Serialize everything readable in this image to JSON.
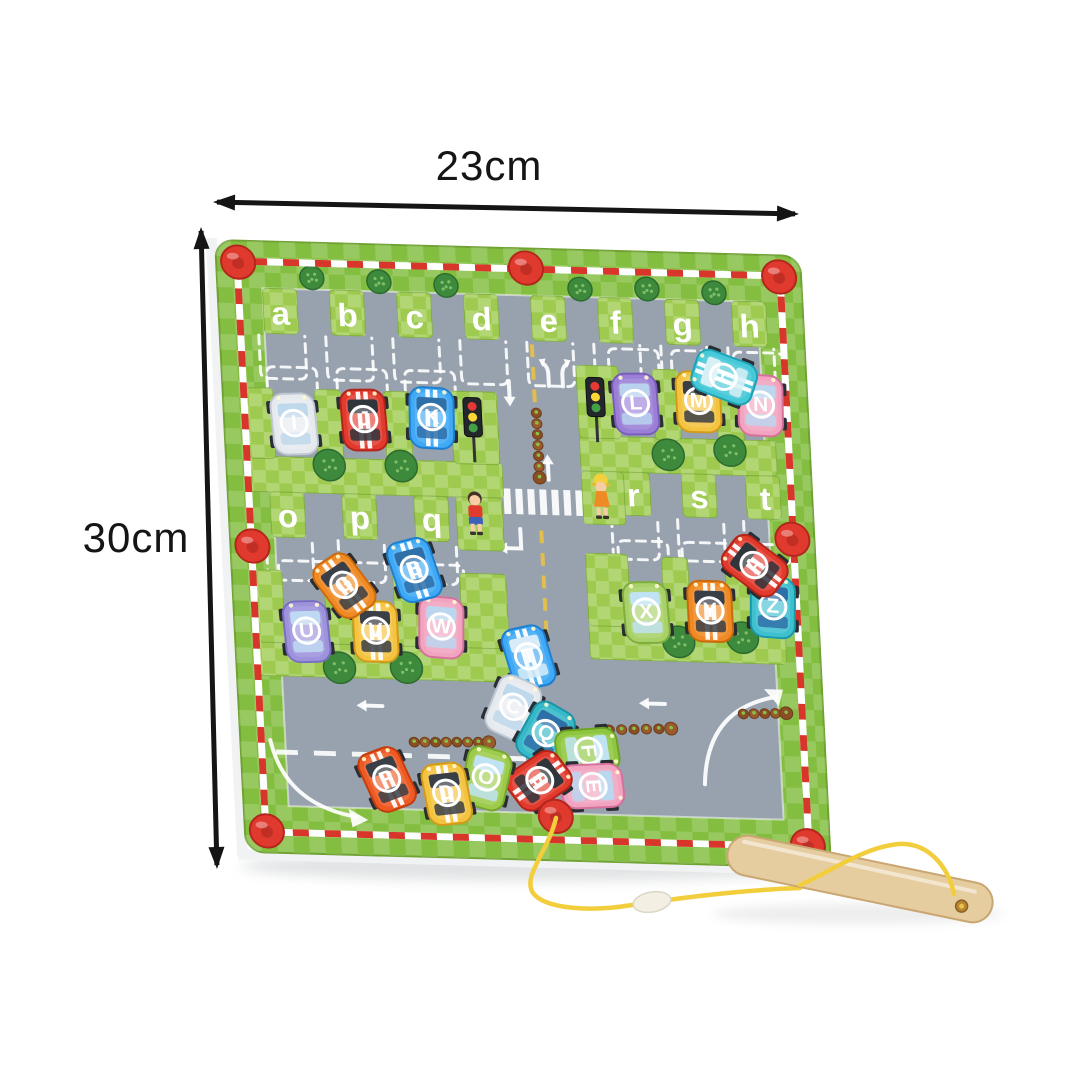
{
  "annotations": {
    "width_label": "23cm",
    "height_label": "30cm"
  },
  "colors": {
    "background": "#ffffff",
    "border_green": "#84BE41",
    "border_check": "rgba(255,255,255,0.17)",
    "maze_green": "#9ECB4F",
    "maze_check": "rgba(255,255,255,0.22)",
    "play_gray": "#98A2AE",
    "track_red": "#D8362B",
    "track_white": "#FFFFFF",
    "knob_red": "#E03A2F",
    "knob_dark": "#B3261C",
    "slot_dash": "#FFFFFF",
    "letter_white": "#FFFFFF",
    "road_yellow": "#E2BE4E",
    "tree_green": "#3E8A3C",
    "tree_dark": "#2C6B2F",
    "tree_dot": "#7FBF6A",
    "caterpillar_body": "#9A5A2B",
    "caterpillar_alt": "#8A4E22",
    "caterpillar_line": "#6B3E1D",
    "caterpillar_dot": "#86C34D",
    "wand_wood": "#E6CDA0",
    "wand_edge": "#C9A672",
    "string_yellow": "#F2CE3C",
    "bead": "#F3EFE2",
    "bead_edge": "#DCD6C4",
    "arrow_black": "#151515",
    "rim_white": "#F0F2F3",
    "shadow": "rgba(120,128,134,0.22)"
  },
  "dim_arrows": [
    [
      213,
      202,
      799,
      214
    ],
    [
      201,
      227,
      217,
      869
    ]
  ],
  "board": {
    "matrix": "matrix(1 0.0274 0.0496 0.979 215 240)",
    "width": 585,
    "height": 625,
    "border": 45,
    "top_letters": [
      "a",
      "b",
      "c",
      "d",
      "e",
      "f",
      "g",
      "h"
    ],
    "top_letter_xs": [
      62,
      129,
      196,
      263,
      330,
      397,
      464,
      531
    ],
    "top_letter_y": 73,
    "mid_left": {
      "letters": [
        "o",
        "p",
        "q"
      ],
      "xs": [
        59,
        131,
        203
      ],
      "y": 280
    },
    "mid_right": {
      "letters": [
        "r",
        "s",
        "t"
      ],
      "xs": [
        406,
        472,
        538
      ],
      "y": 249
    },
    "bars": [
      [
        20,
        220,
        256,
        36
      ],
      [
        355,
        190,
        196,
        36
      ],
      [
        18,
        408,
        266,
        36
      ],
      [
        355,
        382,
        196,
        36
      ]
    ],
    "tabs": [
      [
        45,
        48,
        34,
        46
      ],
      [
        112,
        48,
        34,
        46
      ],
      [
        179,
        48,
        34,
        46
      ],
      [
        246,
        48,
        34,
        46
      ],
      [
        313,
        48,
        34,
        46
      ],
      [
        380,
        48,
        34,
        46
      ],
      [
        447,
        48,
        34,
        46
      ],
      [
        514,
        48,
        34,
        46
      ],
      [
        24,
        150,
        26,
        72
      ],
      [
        92,
        150,
        26,
        72
      ],
      [
        161,
        150,
        26,
        72
      ],
      [
        228,
        148,
        46,
        74
      ],
      [
        42,
        256,
        34,
        46
      ],
      [
        114,
        256,
        34,
        46
      ],
      [
        186,
        256,
        34,
        46
      ],
      [
        228,
        256,
        46,
        54
      ],
      [
        355,
        118,
        42,
        74
      ],
      [
        431,
        120,
        26,
        72
      ],
      [
        494,
        118,
        26,
        74
      ],
      [
        389,
        226,
        34,
        44
      ],
      [
        455,
        226,
        34,
        44
      ],
      [
        519,
        226,
        34,
        44
      ],
      [
        355,
        226,
        42,
        54
      ],
      [
        24,
        336,
        26,
        74
      ],
      [
        92,
        336,
        26,
        74
      ],
      [
        161,
        336,
        26,
        74
      ],
      [
        228,
        334,
        46,
        76
      ],
      [
        355,
        310,
        42,
        74
      ],
      [
        431,
        312,
        26,
        72
      ],
      [
        494,
        310,
        26,
        74
      ]
    ],
    "slots_open_top": [
      [
        62,
        96,
        140,
        46
      ],
      [
        129,
        96,
        140,
        46
      ],
      [
        196,
        96,
        140,
        46
      ],
      [
        263,
        96,
        140,
        46
      ],
      [
        330,
        96,
        140,
        46
      ],
      [
        397,
        96,
        140,
        46
      ],
      [
        464,
        96,
        140,
        46
      ],
      [
        531,
        96,
        140,
        46
      ],
      [
        59,
        304,
        346,
        46
      ],
      [
        131,
        304,
        346,
        46
      ],
      [
        203,
        304,
        346,
        46
      ],
      [
        406,
        273,
        315,
        46
      ],
      [
        472,
        273,
        315,
        46
      ],
      [
        538,
        273,
        315,
        46
      ]
    ],
    "slots_open_bottom": [
      [
        70,
        128,
        212,
        50
      ],
      [
        140,
        128,
        212,
        50
      ],
      [
        208,
        128,
        212,
        50
      ],
      [
        413,
        100,
        184,
        50
      ],
      [
        476,
        100,
        184,
        50
      ],
      [
        538,
        100,
        184,
        50
      ],
      [
        72,
        326,
        404,
        50
      ],
      [
        141,
        326,
        404,
        50
      ],
      [
        207,
        326,
        404,
        50
      ],
      [
        413,
        296,
        376,
        50
      ],
      [
        477,
        296,
        376,
        50
      ],
      [
        540,
        296,
        376,
        50
      ]
    ],
    "trees": [
      [
        95,
        36,
        12
      ],
      [
        162,
        38,
        12
      ],
      [
        229,
        40,
        12
      ],
      [
        363,
        40,
        12
      ],
      [
        430,
        38,
        12
      ],
      [
        497,
        40,
        12
      ],
      [
        103,
        227,
        16
      ],
      [
        175,
        226,
        16
      ],
      [
        443,
        207,
        16
      ],
      [
        505,
        201,
        16
      ],
      [
        103,
        434,
        16
      ],
      [
        170,
        432,
        16
      ],
      [
        444,
        398,
        16
      ],
      [
        508,
        392,
        16
      ]
    ],
    "knobs": [
      [
        22,
        22
      ],
      [
        310,
        20
      ],
      [
        563,
        22
      ],
      [
        22,
        312
      ],
      [
        563,
        290
      ],
      [
        22,
        603
      ],
      [
        563,
        603
      ],
      [
        312,
        580
      ]
    ],
    "traffic_lights": [
      [
        249,
        178
      ],
      [
        373,
        154
      ]
    ],
    "kids": [
      {
        "x": 247,
        "y": 272,
        "variant": "boy"
      },
      {
        "x": 374,
        "y": 252,
        "variant": "girl"
      }
    ],
    "caterpillars": [
      [
        313,
        168,
        313,
        234
      ],
      [
        174,
        508,
        249,
        506
      ],
      [
        370,
        490,
        432,
        487
      ],
      [
        505,
        470,
        548,
        468
      ]
    ],
    "road": {
      "center_dash_x": 312,
      "center_dash_segments": [
        [
          98,
          168
        ],
        [
          288,
          400
        ]
      ],
      "lane_dash": {
        "y": 522,
        "x1": 35,
        "x2": 355
      },
      "crosswalk": {
        "x": 276,
        "y": 246,
        "n": 7,
        "w": 7,
        "gap": 5,
        "h": 26
      },
      "arrows": [
        {
          "type": "down",
          "x": 287,
          "y": 146
        },
        {
          "type": "fork",
          "x": 334,
          "y": 124
        },
        {
          "type": "up",
          "x": 322,
          "y": 226
        },
        {
          "type": "corner-left",
          "x": 281,
          "y": 301
        },
        {
          "type": "left",
          "x": 134,
          "y": 472
        },
        {
          "type": "left",
          "x": 417,
          "y": 462
        },
        {
          "type": "arc",
          "path": "M30,510 Q42,575 112,586",
          "head": "124,589 105,578 108,597"
        },
        {
          "type": "arc",
          "path": "M537,452 Q468,466 463,543",
          "head": "546,444 527,444 541,461"
        }
      ]
    },
    "cars": [
      {
        "letter": "I",
        "x": 70,
        "y": 186,
        "rot": -3,
        "body": "#E6EAEE",
        "trim": "#BEC7D2",
        "window": "#BFD9EC",
        "stripe": null
      },
      {
        "letter": "J",
        "x": 140,
        "y": 180,
        "rot": -2,
        "body": "#E23B2E",
        "trim": "#B32519",
        "window": "#30343B",
        "stripe": "#FFFFFF"
      },
      {
        "letter": "K",
        "x": 208,
        "y": 176,
        "rot": 2,
        "body": "#3FA9F5",
        "trim": "#1E7FD0",
        "window": "#2F6FA8",
        "stripe": "#FFFFFF"
      },
      {
        "letter": "L",
        "x": 413,
        "y": 156,
        "rot": -2,
        "body": "#9B7FD6",
        "trim": "#7A5DBA",
        "window": "#B9D3EE",
        "stripe": null
      },
      {
        "letter": "M",
        "x": 476,
        "y": 152,
        "rot": 0,
        "body": "#F4C33F",
        "trim": "#D19A1B",
        "window": "#3A3F47",
        "stripe": null
      },
      {
        "letter": "N",
        "x": 538,
        "y": 154,
        "rot": 2,
        "body": "#F2A3C0",
        "trim": "#D5719B",
        "window": "#BBD6EF",
        "stripe": null
      },
      {
        "letter": "H",
        "x": 503,
        "y": 126,
        "rot": -70,
        "body": "#45C8D8",
        "trim": "#1FA2B5",
        "window": "#D7F0F6",
        "stripe": "#FFFFFF"
      },
      {
        "letter": "U",
        "x": 72,
        "y": 398,
        "rot": -3,
        "body": "#9D92DC",
        "trim": "#7A6EC2",
        "window": "#BFD9F2",
        "stripe": null
      },
      {
        "letter": "V",
        "x": 141,
        "y": 396,
        "rot": 0,
        "body": "#F4C33F",
        "trim": "#D19A1B",
        "window": "#3A3F47",
        "stripe": "#FFFFFF"
      },
      {
        "letter": "W",
        "x": 207,
        "y": 390,
        "rot": 3,
        "body": "#F2A3C0",
        "trim": "#D5719B",
        "window": "#BBD6EF",
        "stripe": null
      },
      {
        "letter": "G",
        "x": 112,
        "y": 350,
        "rot": -35,
        "body": "#F08A24",
        "trim": "#C96A0C",
        "window": "#3A3F47",
        "stripe": "#FFFFFF"
      },
      {
        "letter": "B",
        "x": 183,
        "y": 332,
        "rot": -16,
        "body": "#3FA9F5",
        "trim": "#1E7FD0",
        "window": "#2F6FA8",
        "stripe": "#FFFFFF"
      },
      {
        "letter": "X",
        "x": 413,
        "y": 369,
        "rot": -2,
        "body": "#A8D168",
        "trim": "#7FAE3E",
        "window": "#BFE3F2",
        "stripe": null
      },
      {
        "letter": "Y",
        "x": 477,
        "y": 366,
        "rot": 0,
        "body": "#F08A24",
        "trim": "#C96A0C",
        "window": "#3A3F47",
        "stripe": "#FFFFFF"
      },
      {
        "letter": "Z",
        "x": 540,
        "y": 360,
        "rot": 3,
        "body": "#3FC0CF",
        "trim": "#1999AB",
        "window": "#2F6FA8",
        "stripe": null
      },
      {
        "letter": "A",
        "x": 524,
        "y": 318,
        "rot": -52,
        "body": "#E23B2E",
        "trim": "#B32519",
        "window": "#30343B",
        "stripe": "#FFFFFF"
      },
      {
        "letter": "T",
        "x": 293,
        "y": 418,
        "rot": -14,
        "body": "#3FA9F5",
        "trim": "#1E7FD0",
        "window": "#D7ECF8",
        "stripe": "#FFFFFF"
      },
      {
        "letter": "C",
        "x": 275,
        "y": 470,
        "rot": 24,
        "body": "#E6EAEE",
        "trim": "#BEC7D2",
        "window": "#BFD9EC",
        "stripe": null
      },
      {
        "letter": "Q",
        "x": 306,
        "y": 496,
        "rot": 30,
        "body": "#35B8C8",
        "trim": "#1C93A5",
        "window": "#2F6FA8",
        "stripe": null
      },
      {
        "letter": "F",
        "x": 347,
        "y": 512,
        "rot": 84,
        "body": "#8FC63F",
        "trim": "#6BA324",
        "window": "#BFE3F2",
        "stripe": null
      },
      {
        "letter": "E",
        "x": 350,
        "y": 548,
        "rot": 86,
        "body": "#F2A3C0",
        "trim": "#D5719B",
        "window": "#BBD6EF",
        "stripe": null
      },
      {
        "letter": "S",
        "x": 297,
        "y": 544,
        "rot": 55,
        "body": "#E23B2E",
        "trim": "#B32519",
        "window": "#30343B",
        "stripe": "#FFFFFF"
      },
      {
        "letter": "O",
        "x": 244,
        "y": 543,
        "rot": 15,
        "body": "#9CCB4C",
        "trim": "#76A82B",
        "window": "#BFE3F2",
        "stripe": null
      },
      {
        "letter": "D",
        "x": 204,
        "y": 560,
        "rot": -8,
        "body": "#F4C33F",
        "trim": "#D19A1B",
        "window": "#3A3F47",
        "stripe": "#FFFFFF"
      },
      {
        "letter": "P",
        "x": 145,
        "y": 547,
        "rot": -22,
        "body": "#EE5A24",
        "trim": "#C43D0D",
        "window": "#3A3F47",
        "stripe": "#FFFFFF"
      }
    ]
  },
  "wand": {
    "cx": 860,
    "cy": 879,
    "angle": 11.7,
    "length": 270,
    "thickness": 40,
    "hole_x": 105,
    "hole_y": 6
  },
  "string": {
    "part_behind": "M556,818 C548,852 522,876 533,893 C545,909 590,912 632,905 C680,898 740,890 800,888",
    "part_over": "M800,885 C830,872 862,848 898,844 C928,842 948,866 954,894",
    "bead": {
      "x": 652,
      "y": 902,
      "rx": 19,
      "ry": 10,
      "rot": -10
    }
  }
}
